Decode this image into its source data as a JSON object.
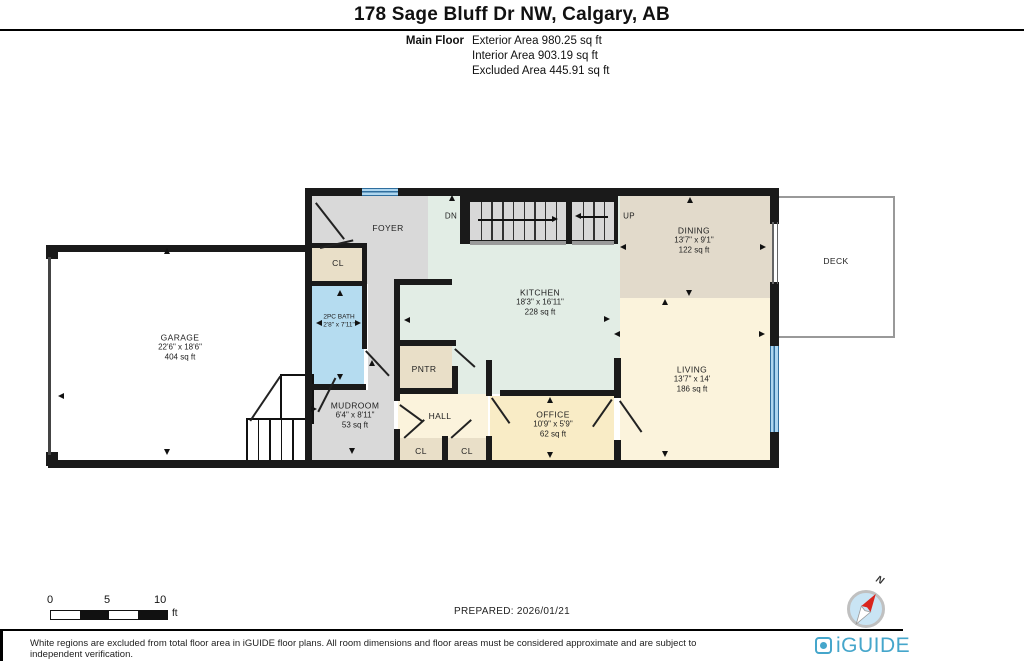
{
  "header": {
    "title": "178 Sage Bluff Dr NW, Calgary, AB"
  },
  "floor_summary": {
    "floor_label": "Main Floor",
    "exterior": "Exterior Area 980.25 sq ft",
    "interior": "Interior Area 903.19 sq ft",
    "excluded": "Excluded Area 445.91 sq ft"
  },
  "rooms": {
    "garage": {
      "name": "GARAGE",
      "dims": "22'6\" x 18'6\"",
      "area": "404 sq ft"
    },
    "foyer": {
      "name": "FOYER"
    },
    "foyer_closet": {
      "name": "CL"
    },
    "bath": {
      "name": "2PC BATH",
      "dims": "2'8\" x 7'11\""
    },
    "kitchen": {
      "name": "KITCHEN",
      "dims": "18'3\" x 16'11\"",
      "area": "228 sq ft"
    },
    "dining": {
      "name": "DINING",
      "dims": "13'7\" x 9'1\"",
      "area": "122 sq ft"
    },
    "deck": {
      "name": "DECK"
    },
    "living": {
      "name": "LIVING",
      "dims": "13'7\" x 14'",
      "area": "186 sq ft"
    },
    "pantry": {
      "name": "PNTR"
    },
    "mudroom": {
      "name": "MUDROOM",
      "dims": "6'4\" x 8'11\"",
      "area": "53 sq ft"
    },
    "hall": {
      "name": "HALL"
    },
    "hall_closet_1": {
      "name": "CL"
    },
    "hall_closet_2": {
      "name": "CL"
    },
    "office": {
      "name": "OFFICE",
      "dims": "10'9\" x 5'9\"",
      "area": "62 sq ft"
    }
  },
  "stairs": {
    "down_label": "DN",
    "up_label": "UP"
  },
  "scale_bar": {
    "tick_0": "0",
    "tick_5": "5",
    "tick_10": "10",
    "unit": "ft"
  },
  "compass": {
    "north_label": "N"
  },
  "footer": {
    "prepared": "PREPARED: 2026/01/21",
    "disclaimer": "White regions are excluded from total floor area in iGUIDE floor plans. All room dimensions and floor areas must be considered approximate and are subject to independent verification.",
    "brand": "iGUIDE"
  },
  "colors": {
    "wall": "#1a1a1a",
    "foyer_gray": "#d9d9d9",
    "kitchen_mint": "#e2ede5",
    "dining_tan": "#e2dacb",
    "living_cream": "#fbf3dc",
    "office_yellow": "#f9ecc6",
    "closet_tan": "#e9dfc8",
    "bath_blue": "#b5dcf0",
    "window_blue": "#5fa8d4",
    "stair_tread": "#d8d8d8",
    "brand_blue": "#45a6cb",
    "compass_red": "#d9251d"
  }
}
